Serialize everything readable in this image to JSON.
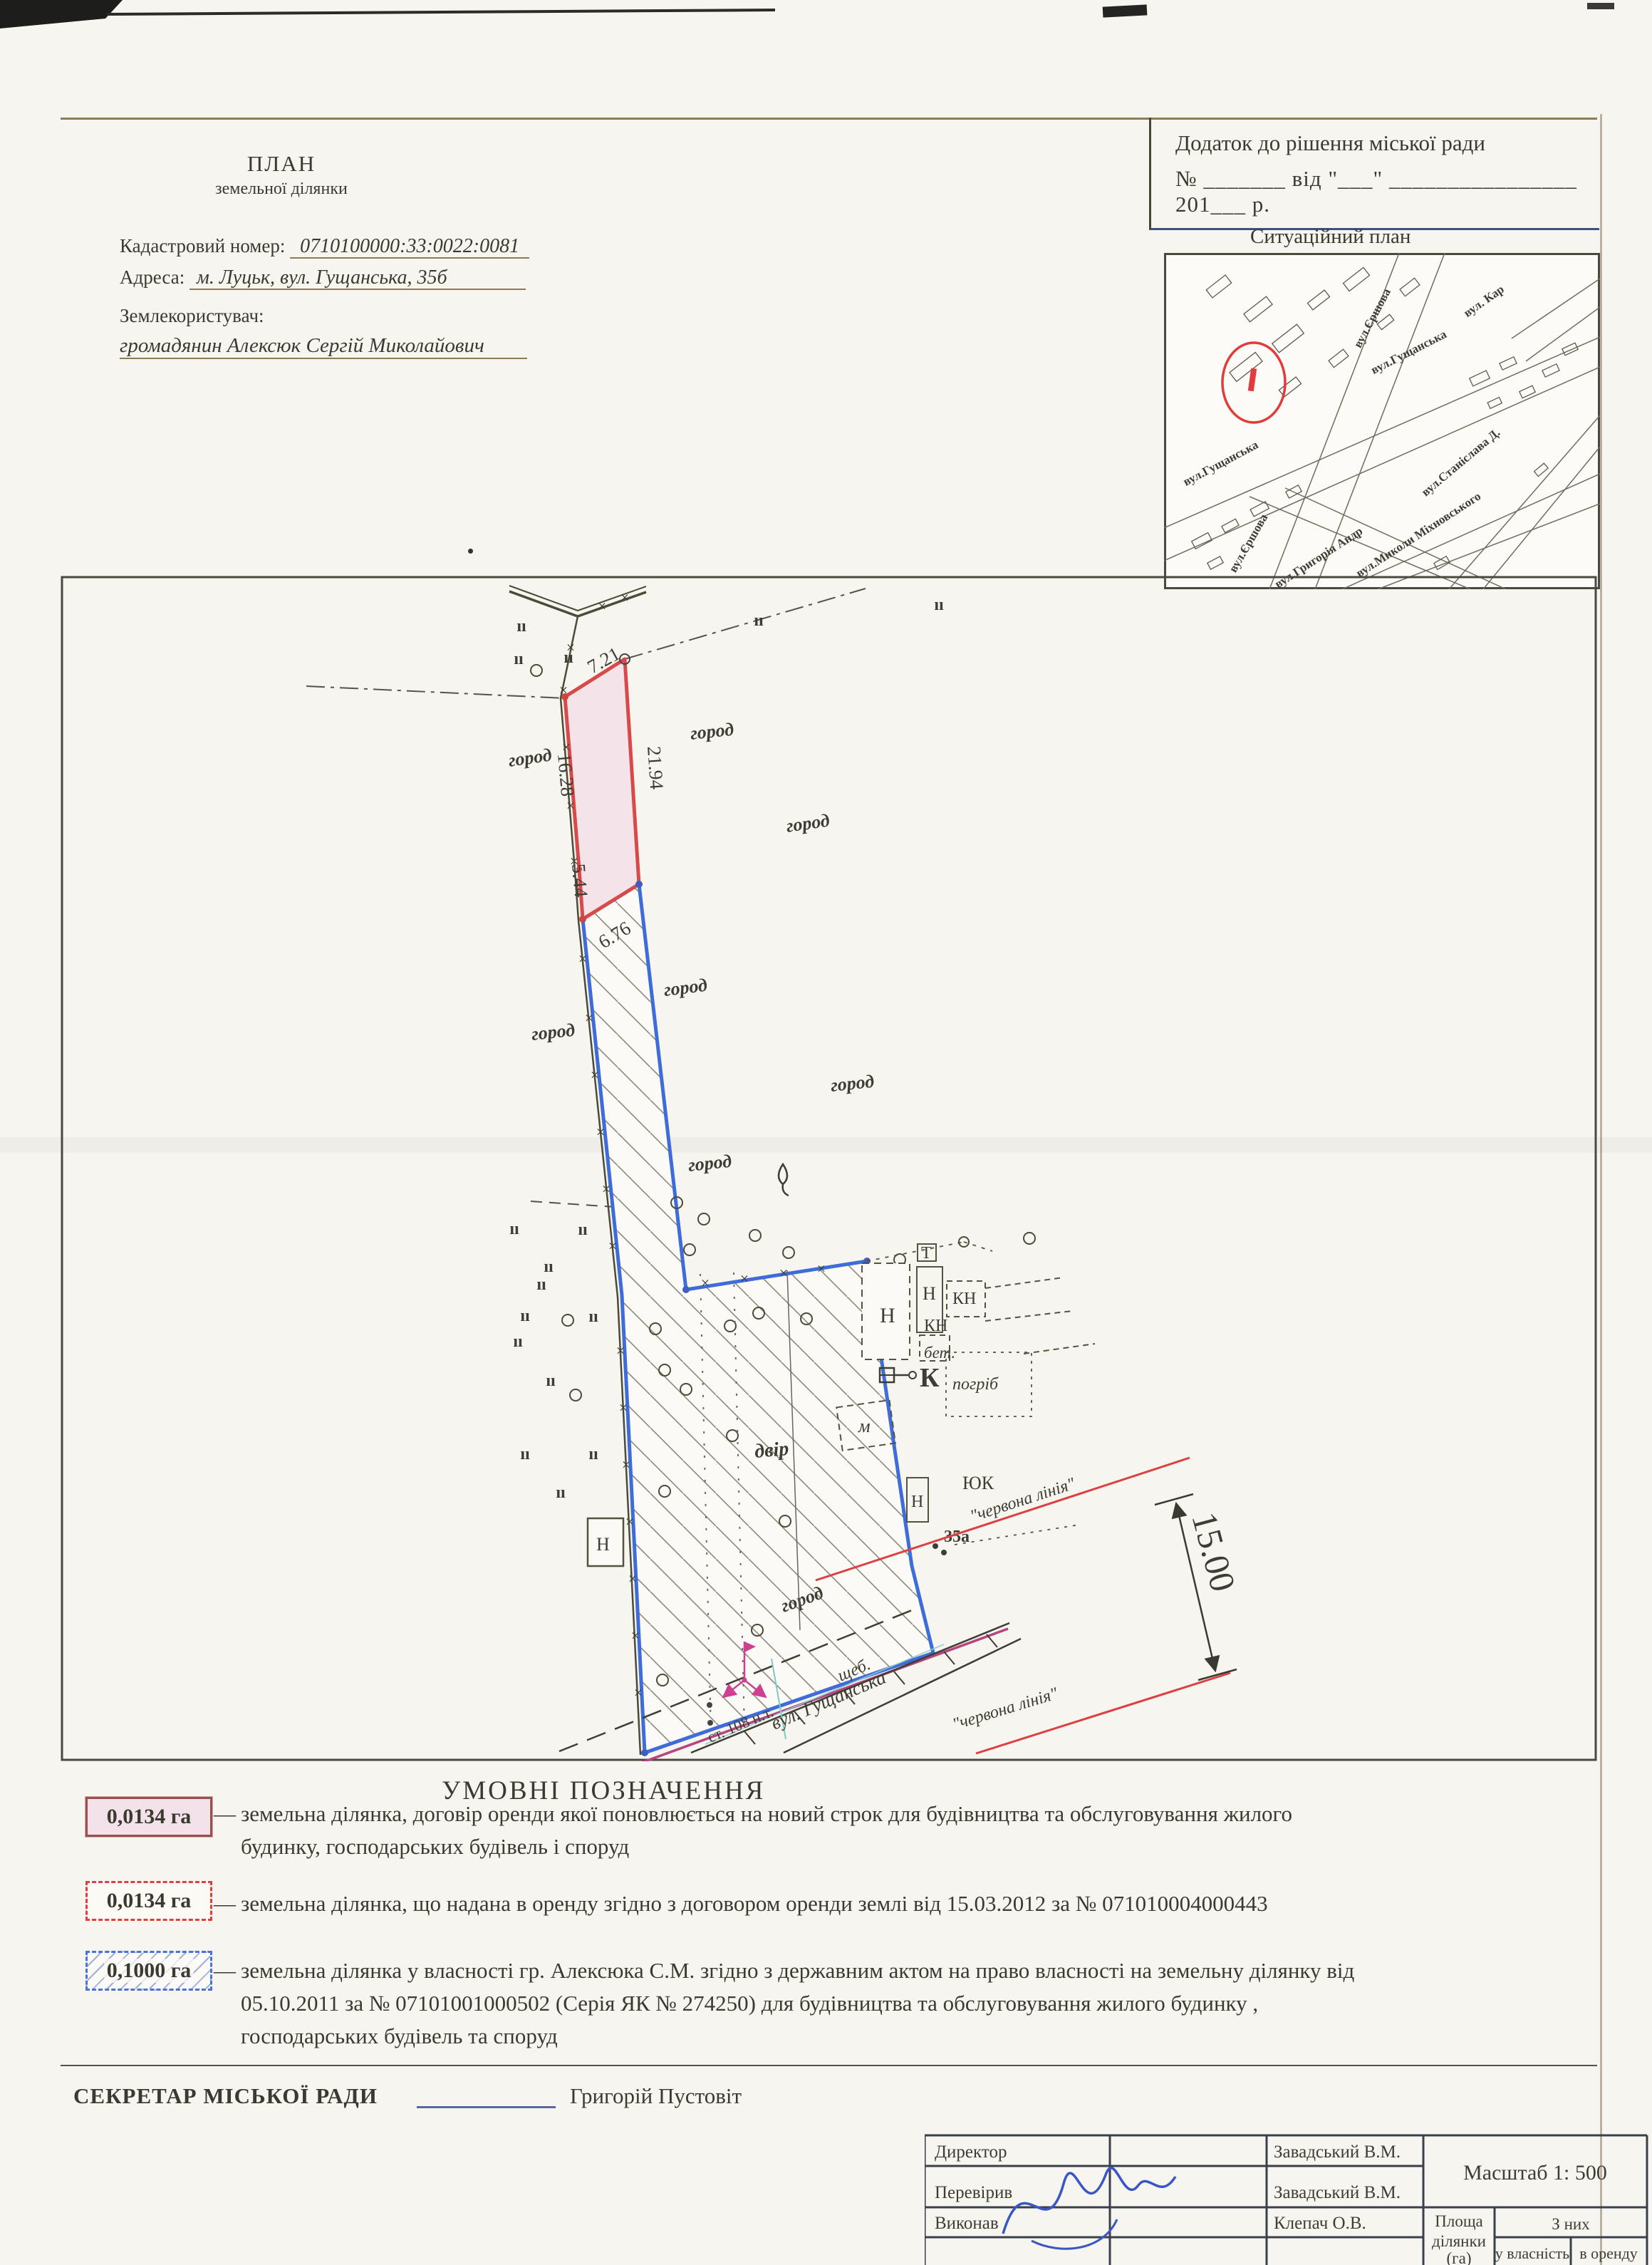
{
  "header": {
    "title1": "ПЛАН",
    "title2": "земельної ділянки",
    "appendix_line1": "Додаток до рішення  міської ради",
    "appendix_line2": "№ _______ від \"___\" ________________ 201___ р.",
    "cadastral_label": "Кадастровий номер:",
    "cadastral_value": "0710100000:33:0022:0081",
    "address_label": "Адреса:",
    "address_value": "м. Луцьк, вул. Гущанська, 35б",
    "landuser_label": "Землекористувач:",
    "landuser_value": "громадянин Алексюк Сергій Миколайович"
  },
  "map": {
    "title": "Ситуаційний план",
    "streets": [
      "вул.Єршова",
      "вул.Гущанська",
      "вул. Кар",
      "вул.Станіслава Д.",
      "вул.Миколи Міхновського",
      "вул.Гущанська",
      "вул.Єршова",
      "вул.Григорія Андр"
    ]
  },
  "drawing": {
    "garden": "город",
    "yard": "двір",
    "dims": {
      "top": "7.21",
      "right": "21.94",
      "left": "16.28",
      "left2": "5.44",
      "bottom": "6.76",
      "street": "15.00"
    },
    "buildings": {
      "t": "Т",
      "n": "Н",
      "kn": "КН",
      "bet": "бет.",
      "k": "К",
      "pogrib": "погріб",
      "m": "м",
      "yuk": "ЮК",
      "n35": "35а"
    },
    "street": {
      "name": "вул. Гущанська",
      "surface": "щеб.",
      "axis": "ст. 108 н.т.",
      "red": "\"червона лінія\""
    },
    "symbols": {
      "tick": "×",
      "grass": "ıı"
    }
  },
  "legend": {
    "title": "УМОВНІ   ПОЗНАЧЕННЯ",
    "dash": "—",
    "entries": [
      {
        "area": "0,0134 га",
        "l1": "земельна ділянка, договір оренди якої поновлюється на новий строк  для будівництва та обслуговування жилого",
        "l2": "будинку, господарських будівель і споруд"
      },
      {
        "area": "0,0134 га",
        "l1": "земельна ділянка, що надана в оренду згідно з договором оренди землі від 15.03.2012 за №   071010004000443"
      },
      {
        "area": "0,1000 га",
        "l1": "земельна ділянка  у власності гр. Алексюка С.М.  згідно з державним актом на право  власності на земельну ділянку від",
        "l2": "05.10.2011 за № 07101001000502 (Серія ЯК №  274250) для будівництва та обслуговування  жилого будинку ,",
        "l3": "господарських будівель та споруд"
      }
    ]
  },
  "secretary": {
    "label": "СЕКРЕТАР МІСЬКОЇ РАДИ",
    "name": "Григорій Пустовіт"
  },
  "table": {
    "rows": [
      {
        "role": "Директор",
        "name": "Завадський В.М."
      },
      {
        "role": "Перевірив",
        "name": "Завадський В.М."
      },
      {
        "role": "Виконав",
        "name": "Клепач О.В."
      }
    ],
    "scale": "Масштаб  1: 500",
    "area_l1": "Площа",
    "area_l2": "ділянки",
    "area_l3": "(га)",
    "of_them": "З них",
    "own": "у власність",
    "lease": "в оренду"
  },
  "colors": {
    "parcel_red": "#d84a4a",
    "parcel_pink": "#f5e3ea",
    "parcel_blue": "#3e6cd8",
    "red_line": "#dd4040",
    "magenta": "#c2418f"
  }
}
